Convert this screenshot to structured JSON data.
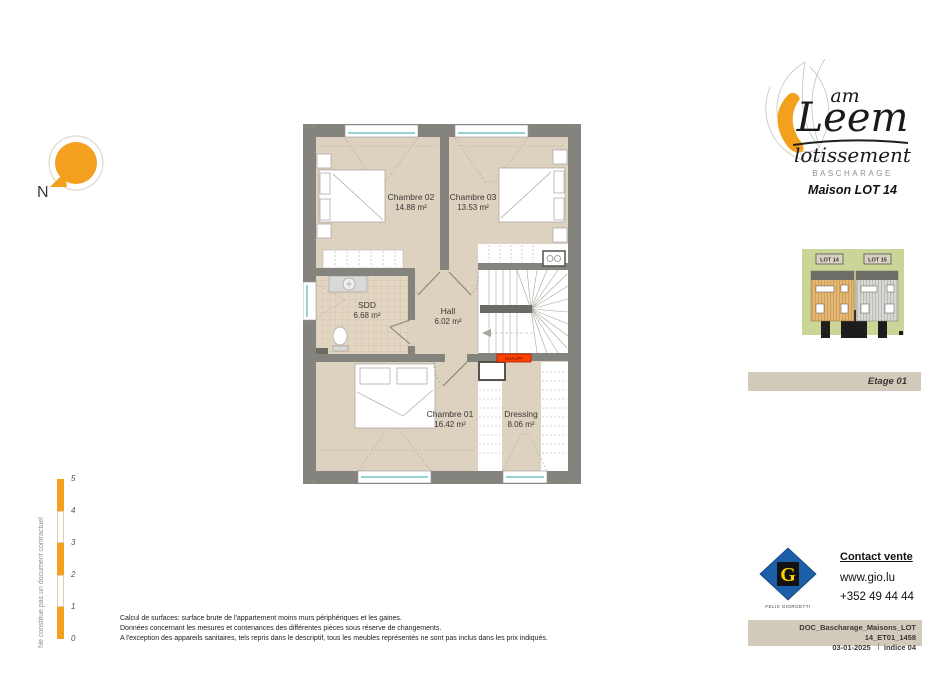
{
  "header": {
    "logo_am": "am",
    "logo_leem": "Leem",
    "logo_lotissement": "lotissement",
    "logo_city": "BASCHARAGE",
    "title": "Maison LOT 14"
  },
  "compass": {
    "north": "N"
  },
  "plan": {
    "rooms": [
      {
        "name": "Chambre 02",
        "area": "14.88 m²"
      },
      {
        "name": "Chambre 03",
        "area": "13.53 m²"
      },
      {
        "name": "SDD",
        "area": "6.68 m²"
      },
      {
        "name": "Hall",
        "area": "6.02 m²"
      },
      {
        "name": "Chambre 01",
        "area": "16.42 m²"
      },
      {
        "name": "Dressing",
        "area": "8.06 m²"
      }
    ],
    "chauff": "CHAUFF"
  },
  "site_plan": {
    "lot_left": "LOT 14",
    "lot_right": "LOT 15"
  },
  "etage": "Etage 01",
  "scale_bar": {
    "ticks": [
      "5",
      "4",
      "3",
      "2",
      "1",
      "0"
    ]
  },
  "side_note": "Ne constitue pas un document contractuel",
  "contact": {
    "heading": "Contact vente",
    "website": "www.gio.lu",
    "phone": "+352 49 44 44",
    "logo_letter": "G",
    "logo_name": "FELIX GIORGETTI"
  },
  "doc_bar": {
    "reference": "DOC_Bascharage_Maisons_LOT 14_ET01_1458",
    "date": "03-01-2025",
    "indice": "indice 04"
  },
  "disclaimer": [
    "Calcul de surfaces: surface brute de l'appartement moins murs périphériques et les gaines.",
    "Données concernant les mesures et contenances des différentes pièces sous réserve de changements.",
    "A l'exception des appareils sanitaires, tels repris dans le descriptif, tous les meubles représentés ne sont pas inclus dans les prix indiqués."
  ],
  "colors": {
    "accent_orange": "#F3A01F",
    "wall_gray": "#85837D",
    "floor_beige": "#DDD1C0",
    "bar_beige": "#D2CBBC",
    "window_teal": "#2FA8A8",
    "chauff_red": "#FF4200",
    "fg_blue": "#1C5FA8",
    "fg_yellow": "#FFD300"
  }
}
